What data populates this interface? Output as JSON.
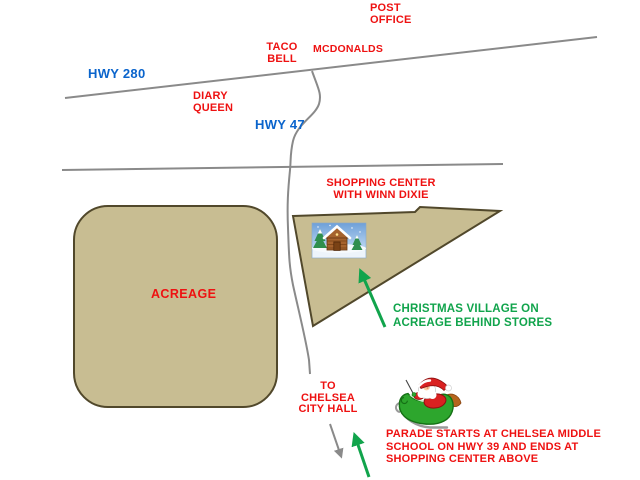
{
  "map": {
    "description": "Hand-drawn directions map to Chelsea Christmas Village and parade route",
    "colors": {
      "red": "#EE1111",
      "blue": "#0A64CC",
      "green": "#11A44C",
      "tan": "#C8BD92",
      "tan_border": "#51482B",
      "road": "#8A8A8A"
    },
    "labels": {
      "post_office": "POST\nOFFICE",
      "taco_bell": "TACO\nBELL",
      "mcdonalds": "MCDONALDS",
      "hwy_280": "HWY 280",
      "diary_queen": "DIARY\nQUEEN",
      "hwy_47": "HWY 47",
      "shopping_center": "SHOPPING CENTER\nWITH WINN DIXIE",
      "acreage": "ACREAGE",
      "christmas_village": "CHRISTMAS VILLAGE ON\nACREAGE BEHIND STORES",
      "to_chelsea": "TO\nCHELSEA\nCITY HALL",
      "parade": "PARADE STARTS AT CHELSEA MIDDLE\nSCHOOL ON HWY 39 AND ENDS AT\nSHOPPING CENTER ABOVE"
    },
    "icons": {
      "christmas_cabin": "christmas-cabin-clipart",
      "santa_sleigh": "santa-in-sleigh-clipart"
    }
  }
}
